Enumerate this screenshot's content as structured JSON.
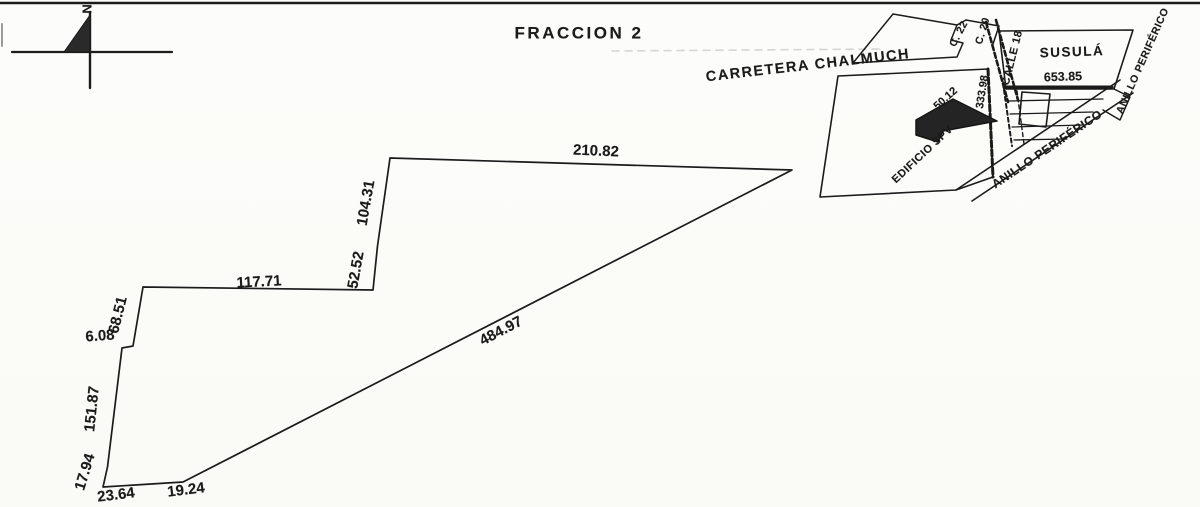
{
  "document": {
    "type": "scanned cadastral survey plan",
    "title": "FRACCION 2",
    "ink_color": "#1b1b1b",
    "paper_color": "#fcfcfa"
  },
  "compass": {
    "north_label": "N"
  },
  "parcel": {
    "name": "FRACCION 2",
    "measurements": [
      {
        "edge": "north",
        "value": "210.82"
      },
      {
        "edge": "northwest-upper",
        "value": "104.31"
      },
      {
        "edge": "northwest-lower",
        "value": "52.52"
      },
      {
        "edge": "west-shelf",
        "value": "117.71"
      },
      {
        "edge": "west-upper",
        "value": "68.51"
      },
      {
        "edge": "west-jog",
        "value": "6.08"
      },
      {
        "edge": "west-main",
        "value": "151.87"
      },
      {
        "edge": "west-foot",
        "value": "17.94"
      },
      {
        "edge": "south-west",
        "value": "23.64"
      },
      {
        "edge": "south-east",
        "value": "19.24"
      },
      {
        "edge": "southeast-diagonal",
        "value": "484.97"
      }
    ]
  },
  "inset": {
    "roads": [
      {
        "name": "carretera-chalmuch",
        "label": "CARRETERA CHALMUCH"
      },
      {
        "name": "calle-22",
        "label": "C. 22"
      },
      {
        "name": "calle-20",
        "label": "C. 20"
      },
      {
        "name": "calle-18",
        "label": "CALLE 18"
      },
      {
        "name": "anillo-periferico-east",
        "label": "ANILLO PERIFÉRICO"
      },
      {
        "name": "anillo-periferico-south",
        "label": "ANILLO PERIFÉRICO"
      }
    ],
    "places": [
      {
        "name": "susula",
        "label": "SUSULÁ"
      },
      {
        "name": "edificio-spv",
        "label": "EDIFICIO SPV"
      }
    ],
    "dimensions": [
      {
        "name": "susula-frontage",
        "value": "653.85"
      },
      {
        "name": "spv-frontage",
        "value": "50.12"
      },
      {
        "name": "west-boundary",
        "value": "333.98"
      }
    ]
  }
}
